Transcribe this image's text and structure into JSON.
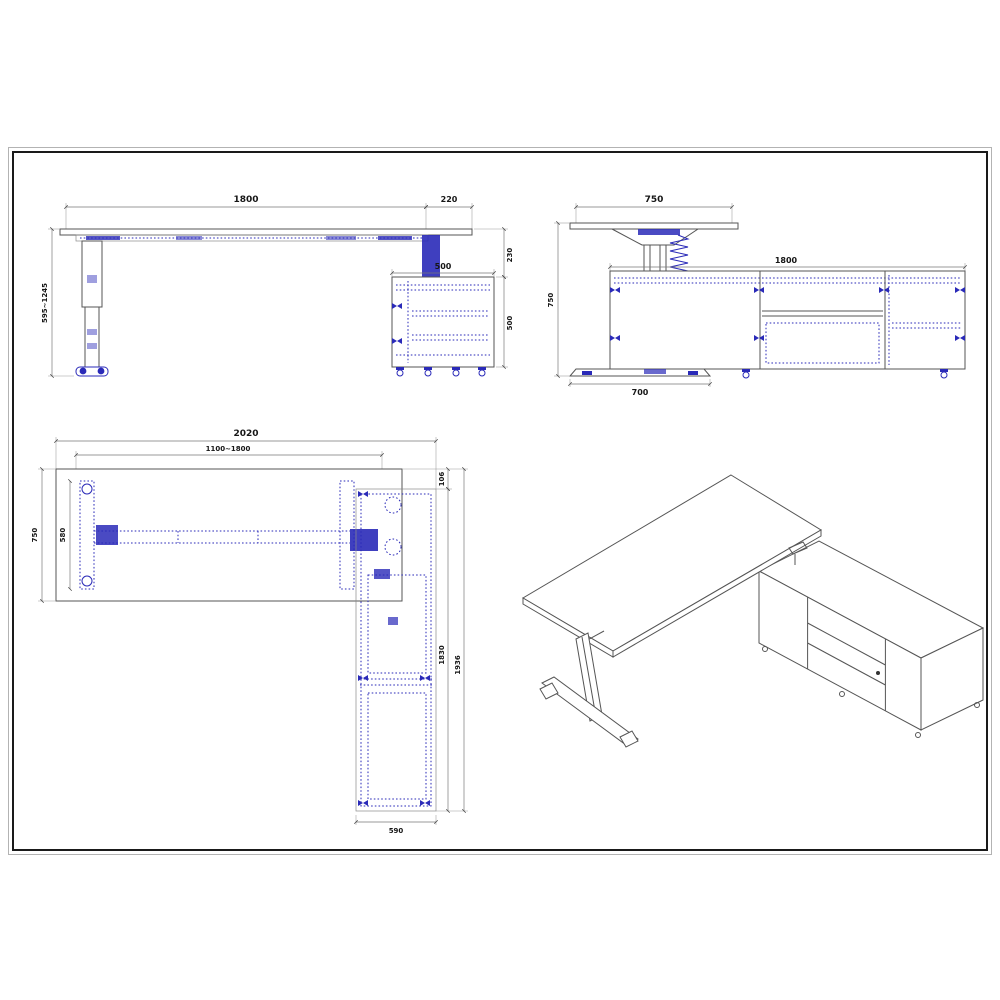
{
  "colors": {
    "drawing_line": "#555555",
    "hardware_blue": "#2a2ab8",
    "frame_border": "#1a1a1a",
    "dimension_text": "#161616"
  },
  "views": {
    "front": {
      "dims": {
        "desk_width": "1800",
        "overhang": "220",
        "height_range": "595~1245",
        "pedestal_width": "500",
        "clearance": "230",
        "pedestal_height": "500"
      }
    },
    "side": {
      "dims": {
        "desk_depth": "750",
        "pedestal_length": "1800",
        "overall_height": "750",
        "foot_length": "700"
      }
    },
    "plan": {
      "dims": {
        "overall_width": "2020",
        "adjustable_width": "1100~1800",
        "desk_depth": "750",
        "frame_depth": "580",
        "top_offset": "106",
        "pedestal_run": "1830",
        "return_length": "1936",
        "return_width": "590"
      }
    }
  }
}
